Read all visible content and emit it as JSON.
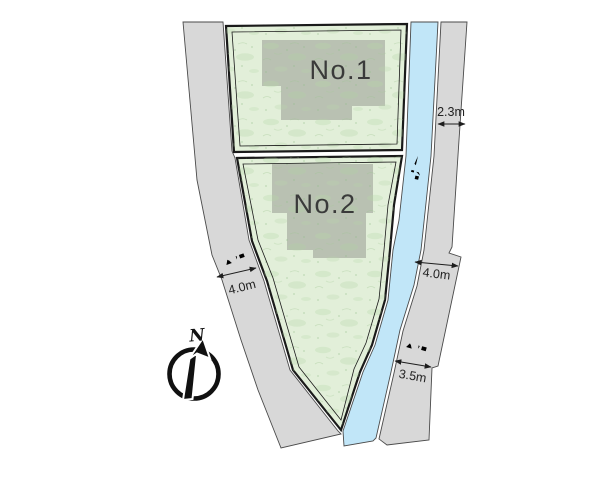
{
  "site_plan": {
    "plots": [
      {
        "label": "No.1"
      },
      {
        "label": "No.2"
      }
    ],
    "waterway": {
      "label": "水路"
    },
    "roads": {
      "left": {
        "label": "公道",
        "width": "4.0m"
      },
      "right": {
        "label": "公道",
        "width_top": "2.3m",
        "width_mid": "4.0m",
        "width_bottom": "3.5m"
      }
    },
    "compass": {
      "north_label": "N"
    },
    "colors": {
      "plot_green": "#e2efd9",
      "building_gray": "#b9c1b2",
      "road_gray": "#d8d8d8",
      "water_blue": "#c1e6f8",
      "outline": "#1a1a1a"
    }
  }
}
